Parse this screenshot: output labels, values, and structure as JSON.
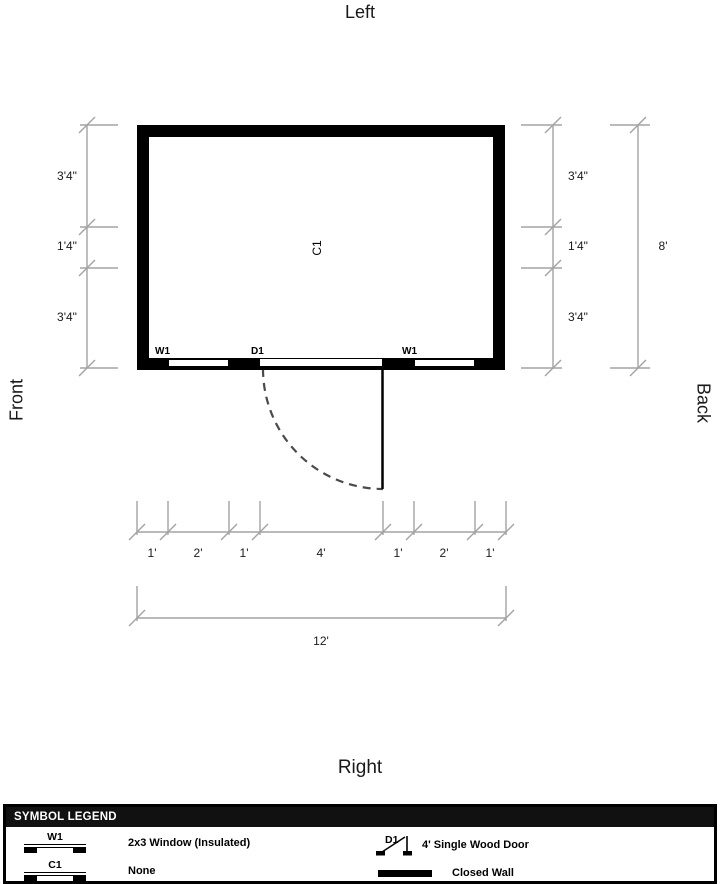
{
  "orientation": {
    "top": "Left",
    "bottom": "Right",
    "left_side": "Front",
    "right_side": "Back"
  },
  "plan": {
    "center_label": "C1",
    "opening_labels": {
      "window_left": "W1",
      "door": "D1",
      "window_right": "W1"
    }
  },
  "dimensions": {
    "left": [
      "3'4\"",
      "1'4\"",
      "3'4\""
    ],
    "right": [
      "3'4\"",
      "1'4\"",
      "3'4\""
    ],
    "right_total": "8'",
    "bottom": [
      "1'",
      "2'",
      "1'",
      "4'",
      "1'",
      "2'",
      "1'"
    ],
    "bottom_total": "12'"
  },
  "legend": {
    "title": "SYMBOL LEGEND",
    "items": [
      {
        "symbol": "W1",
        "label": "2x3 Window (Insulated)"
      },
      {
        "symbol": "D1",
        "label": "4' Single Wood Door"
      },
      {
        "symbol": "C1",
        "label": "None"
      },
      {
        "symbol": "",
        "label": "Closed Wall"
      }
    ]
  },
  "colors": {
    "wall": "#000000",
    "dimension_lines": "#a3a3a3",
    "door_swing": "#4a4a4a",
    "legend_header_bg": "#111111"
  }
}
